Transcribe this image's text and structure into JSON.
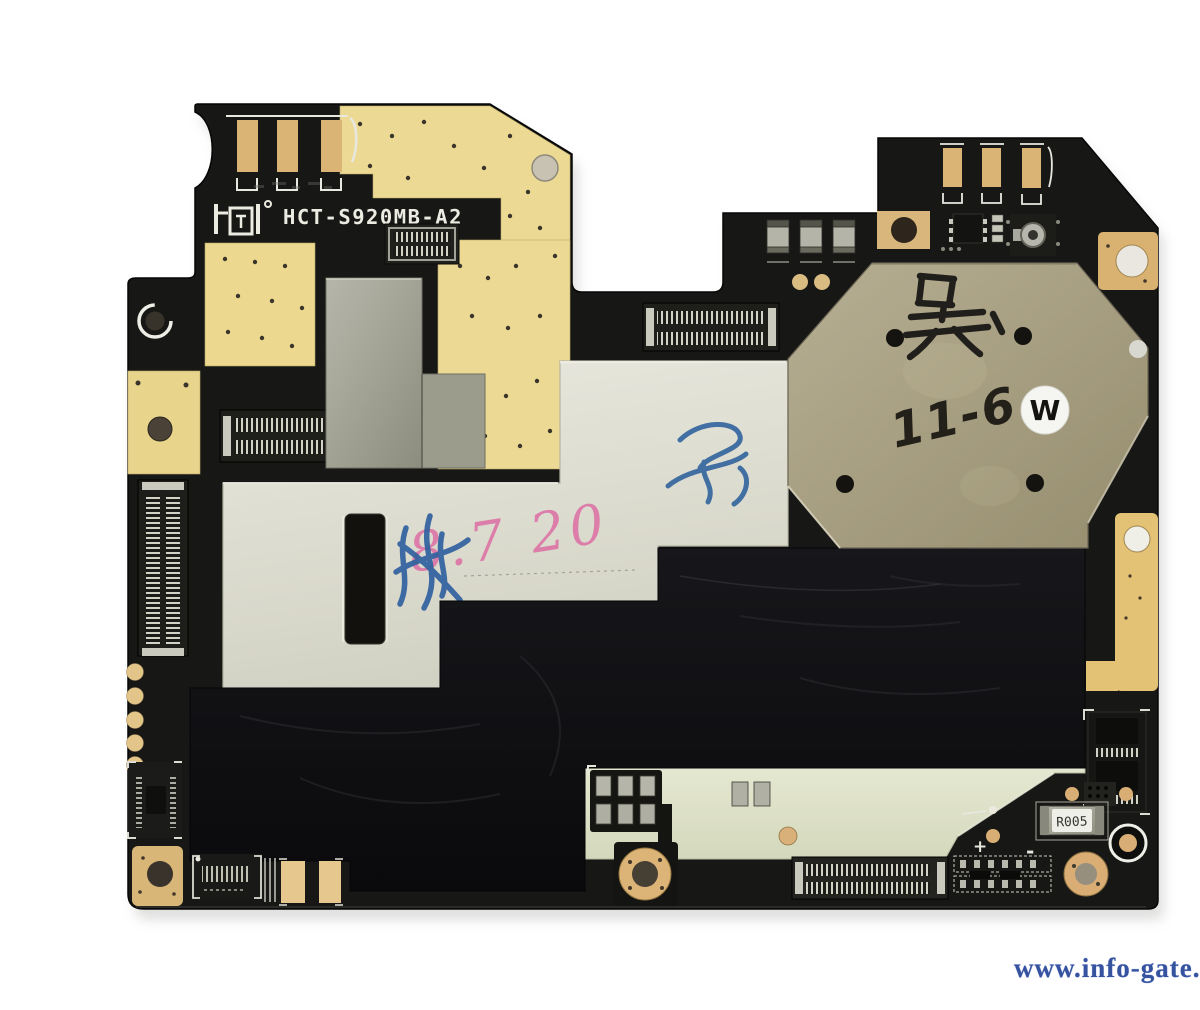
{
  "scene": {
    "type": "photograph",
    "subject": "Smartphone motherboard (logic board PCB), component side, isolated on white background"
  },
  "silkscreen": {
    "logo": "HCT",
    "model": "HCT-S920MB-A2",
    "shunt_resistor_label": "R005",
    "plus": "+",
    "minus": "-"
  },
  "handwriting": {
    "black_marker_character": "吴",
    "black_marker_date": "11-6",
    "round_sticker_letter": "W",
    "pink_marker_note": "8.7 20"
  },
  "watermark": {
    "text": "www.info-gate.gr",
    "color": "#35539f"
  },
  "palette": {
    "background": "#ffffff",
    "pcb_black": "#171716",
    "copper_yellow": "#ecd993",
    "gold_pad_tan": "#d9b378",
    "shield_silver": "#a6a699",
    "shield_white": "#dcdbd0",
    "shield_olive": "#a69d80",
    "shield_pale_green": "#dfe2ca",
    "graphite_tape": "#101013",
    "marker_black": "#211f1b",
    "marker_pink": "#e06ba4",
    "marker_blue": "#30619f"
  }
}
